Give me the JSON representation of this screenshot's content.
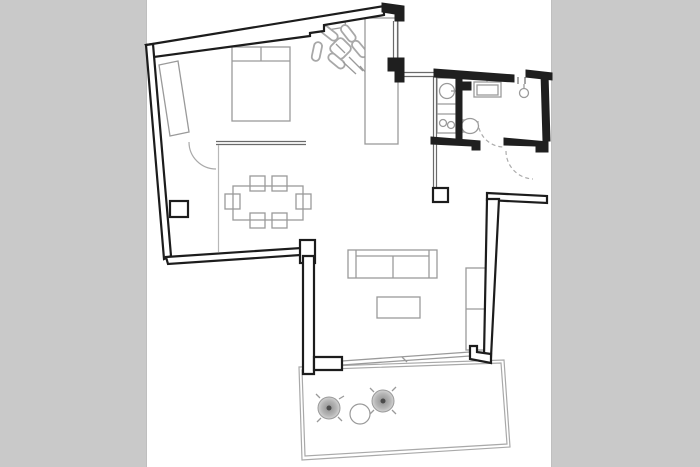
{
  "image": {
    "kind": "apartment floor plan drawing, no text labels",
    "width_px": 700,
    "height_px": 467
  },
  "colors": {
    "side_matte": "#c9c9c9",
    "canvas": "#ffffff",
    "wall": "#1f1f1f",
    "furniture_line": "#9a9a9a",
    "light_line": "#b8b8b8",
    "door_arc": "#ababab",
    "terrace_chair_center": "#4a4a4a",
    "terrace_chair_shade": "#bdbdbd"
  },
  "floorplan": {
    "rooms": [
      {
        "name": "bedroom",
        "furniture": [
          "double-bed",
          "headboard-shelf",
          "wardrobe",
          "potted-plant"
        ]
      },
      {
        "name": "dining-area",
        "furniture": [
          "dining-table",
          "six-chairs"
        ]
      },
      {
        "name": "living-area",
        "furniture": [
          "sofa",
          "coffee-table",
          "tv-cabinet"
        ]
      },
      {
        "name": "kitchen-strip",
        "furniture": [
          "tall-cabinet",
          "washing-machine",
          "double-sink-counter"
        ]
      },
      {
        "name": "bathroom",
        "furniture": [
          "wash-basin",
          "toilet"
        ]
      },
      {
        "name": "shower-room",
        "furniture": [
          "shower-head"
        ]
      },
      {
        "name": "hallway",
        "furniture": [
          "column"
        ]
      },
      {
        "name": "terrace",
        "furniture": [
          "round-chair",
          "round-chair",
          "round-table"
        ]
      }
    ],
    "doors": [
      "bedroom-door-arc",
      "bathroom-door-arc-dashed",
      "entry-door-arc-dashed",
      "terrace-sliding-door"
    ],
    "annotations_text": []
  }
}
